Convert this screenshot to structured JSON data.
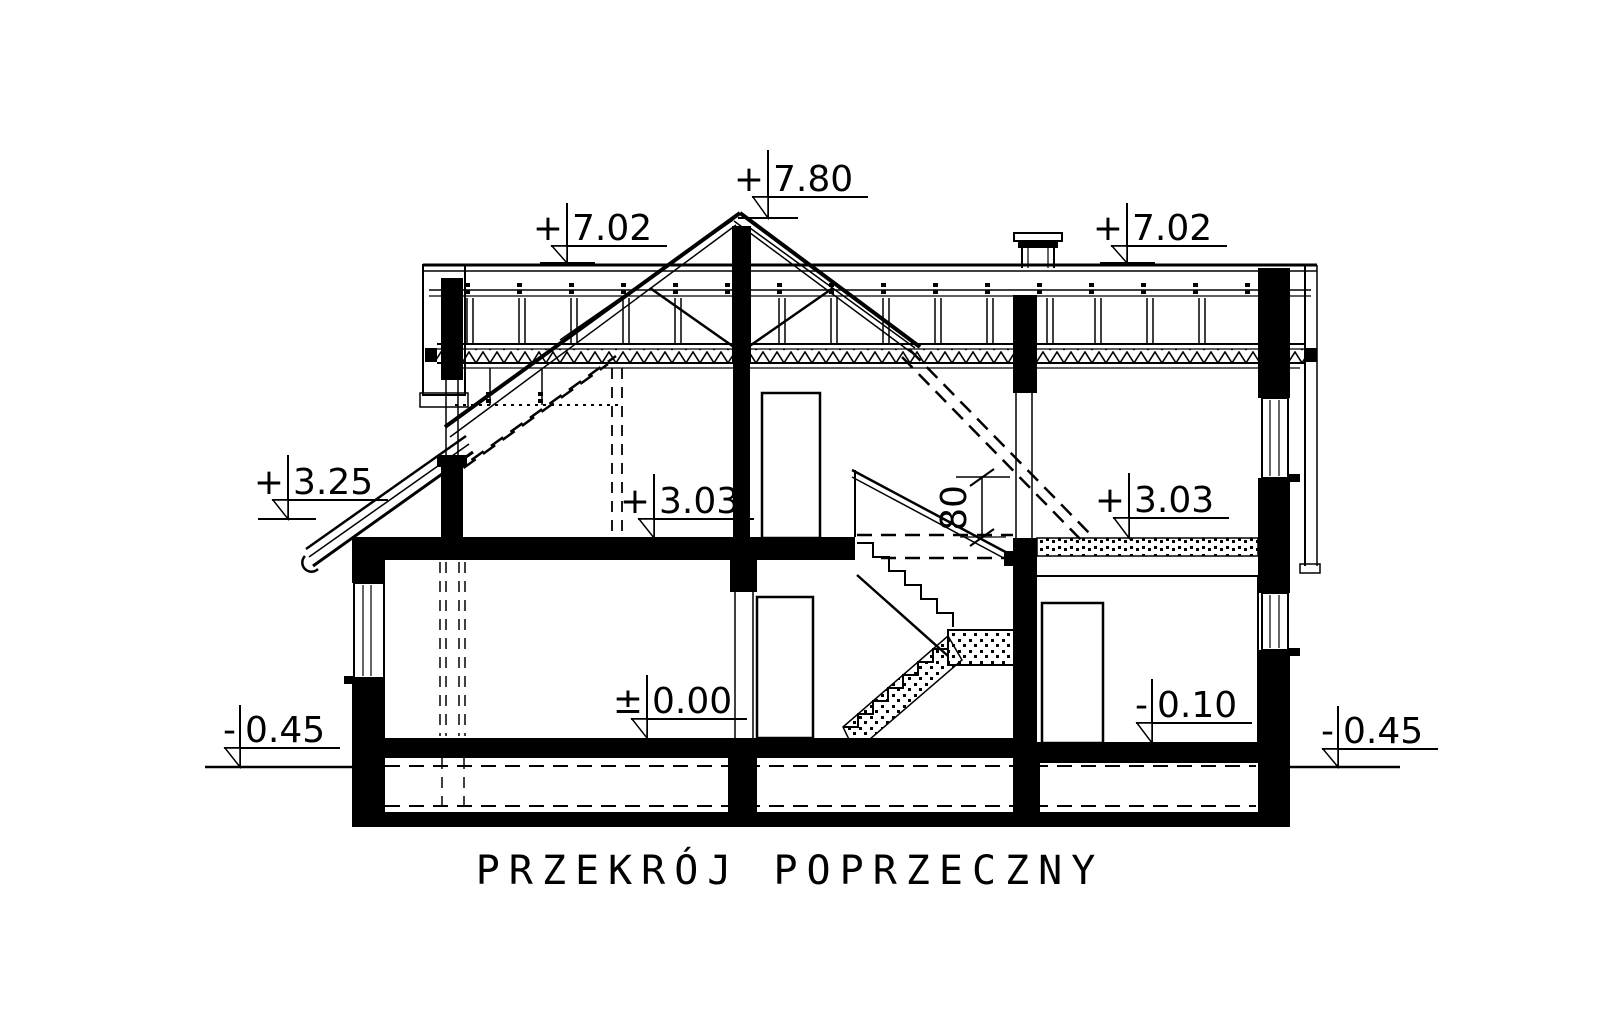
{
  "title": "PRZEKRÓJ POPRZECZNY",
  "levels": {
    "ridge": {
      "sign": "+",
      "value": "7.80"
    },
    "roof_left": {
      "sign": "+",
      "value": "7.02"
    },
    "roof_right": {
      "sign": "+",
      "value": "7.02"
    },
    "porch_eave": {
      "sign": "+",
      "value": "3.25"
    },
    "attic_floor_center": {
      "sign": "+",
      "value": "3.03"
    },
    "attic_floor_right": {
      "sign": "+",
      "value": "3.03"
    },
    "ground_floor": {
      "sign": "±",
      "value": "0.00"
    },
    "garage_floor": {
      "sign": "-",
      "value": "0.10"
    },
    "terrain_left": {
      "sign": "-",
      "value": "0.45"
    },
    "terrain_right": {
      "sign": "-",
      "value": "0.45"
    }
  },
  "dimensions": {
    "stair_parapet_height": "80"
  },
  "colors": {
    "ink": "#000000",
    "paper": "#ffffff"
  }
}
